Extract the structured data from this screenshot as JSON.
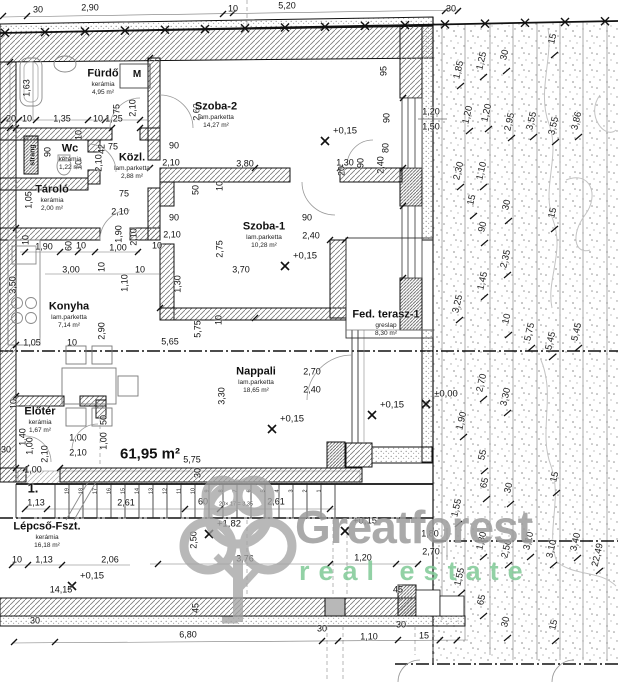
{
  "plan": {
    "unit_number": "1.",
    "total_area": "61,95 m²",
    "stair_note": "20× 17 = 3,35",
    "riser_label": "strang",
    "washer_label": "M"
  },
  "watermark": {
    "brand": "Greatforest",
    "tagline": "real estate",
    "brand_color": "#9c9c9c",
    "tagline_color": "#7fca96"
  },
  "rooms": [
    {
      "name": "Fürdő",
      "finish": "kerámia",
      "area": "4,95 m²",
      "x": 103,
      "y": 74
    },
    {
      "name": "Wc",
      "finish": "kerámia",
      "area": "1,22 m²",
      "x": 70,
      "y": 149
    },
    {
      "name": "Közl.",
      "finish": "lam.parketta",
      "area": "2,88 m²",
      "x": 132,
      "y": 158
    },
    {
      "name": "Tároló",
      "finish": "kerámia",
      "area": "2,00 m²",
      "x": 52,
      "y": 190
    },
    {
      "name": "Szoba-2",
      "finish": "lam.parketta",
      "area": "14,27 m²",
      "x": 216,
      "y": 107
    },
    {
      "name": "Szoba-1",
      "finish": "lam.parketta",
      "area": "10,28 m²",
      "x": 264,
      "y": 227
    },
    {
      "name": "Konyha",
      "finish": "lam.parketta",
      "area": "7,14 m²",
      "x": 69,
      "y": 307
    },
    {
      "name": "Nappali",
      "finish": "lam.parketta",
      "area": "18,65 m²",
      "x": 256,
      "y": 372
    },
    {
      "name": "Fed. terasz-1",
      "finish": "greslap",
      "area": "8,30 m²",
      "x": 386,
      "y": 315
    },
    {
      "name": "Előtér",
      "finish": "kerámia",
      "area": "1,67 m²",
      "x": 40,
      "y": 412
    },
    {
      "name": "Lépcső-Fszt.",
      "finish": "kerámia",
      "area": "16,18 m²",
      "x": 47,
      "y": 527
    }
  ],
  "levels": [
    {
      "t": "+0,15",
      "x": 345,
      "y": 131
    },
    {
      "t": "+0,15",
      "x": 305,
      "y": 256
    },
    {
      "t": "+0,15",
      "x": 292,
      "y": 419
    },
    {
      "t": "+0,15",
      "x": 392,
      "y": 405
    },
    {
      "t": "±0,00",
      "x": 446,
      "y": 394
    },
    {
      "t": "+0,15",
      "x": 365,
      "y": 521
    },
    {
      "t": "+1,82",
      "x": 229,
      "y": 524
    },
    {
      "t": "+0,15",
      "x": 92,
      "y": 576
    }
  ],
  "dims": [
    {
      "t": "30",
      "x": 38,
      "y": 10,
      "k": "h"
    },
    {
      "t": "2,90",
      "x": 90,
      "y": 8,
      "k": "h"
    },
    {
      "t": "10",
      "x": 233,
      "y": 9,
      "k": "h"
    },
    {
      "t": "5,20",
      "x": 287,
      "y": 6,
      "k": "h"
    },
    {
      "t": "30",
      "x": 451,
      "y": 9,
      "k": "h"
    },
    {
      "t": "20",
      "x": 11,
      "y": 119,
      "k": "h"
    },
    {
      "t": "10",
      "x": 27,
      "y": 119,
      "k": "h"
    },
    {
      "t": "1,35",
      "x": 62,
      "y": 119,
      "k": "h"
    },
    {
      "t": "10",
      "x": 98,
      "y": 119,
      "k": "h"
    },
    {
      "t": "1,25",
      "x": 114,
      "y": 119,
      "k": "h"
    },
    {
      "t": "1,63",
      "x": 27,
      "y": 88,
      "k": "v"
    },
    {
      "t": "75",
      "x": 117,
      "y": 109,
      "k": "v"
    },
    {
      "t": "2,10",
      "x": 133,
      "y": 108,
      "k": "v"
    },
    {
      "t": "2,63",
      "x": 197,
      "y": 112,
      "k": "v"
    },
    {
      "t": "95",
      "x": 384,
      "y": 71,
      "k": "v"
    },
    {
      "t": "90",
      "x": 387,
      "y": 118,
      "k": "v"
    },
    {
      "t": "1,20",
      "x": 431,
      "y": 112,
      "k": "h"
    },
    {
      "t": "1,50",
      "x": 431,
      "y": 127,
      "k": "h"
    },
    {
      "t": "80",
      "x": 386,
      "y": 148,
      "k": "v"
    },
    {
      "t": "2,40",
      "x": 381,
      "y": 165,
      "k": "v"
    },
    {
      "t": "90",
      "x": 361,
      "y": 163,
      "k": "v"
    },
    {
      "t": "20",
      "x": 342,
      "y": 171,
      "k": "v"
    },
    {
      "t": "1,30",
      "x": 345,
      "y": 163,
      "k": "h"
    },
    {
      "t": "3,80",
      "x": 245,
      "y": 164,
      "k": "h"
    },
    {
      "t": "50",
      "x": 196,
      "y": 190,
      "k": "v"
    },
    {
      "t": "10",
      "x": 220,
      "y": 186,
      "k": "v"
    },
    {
      "t": "42",
      "x": 102,
      "y": 149,
      "k": "v"
    },
    {
      "t": "75",
      "x": 113,
      "y": 147,
      "k": "h"
    },
    {
      "t": "2,10",
      "x": 99,
      "y": 163,
      "k": "v"
    },
    {
      "t": "90",
      "x": 174,
      "y": 146,
      "k": "h"
    },
    {
      "t": "2,10",
      "x": 171,
      "y": 163,
      "k": "h"
    },
    {
      "t": "10",
      "x": 79,
      "y": 135,
      "k": "v"
    },
    {
      "t": "90",
      "x": 48,
      "y": 152,
      "k": "v"
    },
    {
      "t": "10",
      "x": 79,
      "y": 165,
      "k": "v"
    },
    {
      "t": "1,05",
      "x": 29,
      "y": 200,
      "k": "v"
    },
    {
      "t": "75",
      "x": 124,
      "y": 194,
      "k": "h"
    },
    {
      "t": "2,10",
      "x": 120,
      "y": 212,
      "k": "h"
    },
    {
      "t": "90",
      "x": 174,
      "y": 218,
      "k": "h"
    },
    {
      "t": "2,10",
      "x": 172,
      "y": 235,
      "k": "h"
    },
    {
      "t": "10",
      "x": 157,
      "y": 246,
      "k": "h"
    },
    {
      "t": "90",
      "x": 307,
      "y": 218,
      "k": "h"
    },
    {
      "t": "2,40",
      "x": 311,
      "y": 236,
      "k": "h"
    },
    {
      "t": "2,75",
      "x": 220,
      "y": 249,
      "k": "v"
    },
    {
      "t": "3,70",
      "x": 241,
      "y": 270,
      "k": "h"
    },
    {
      "t": "1,30",
      "x": 178,
      "y": 284,
      "k": "v"
    },
    {
      "t": "5,75",
      "x": 198,
      "y": 329,
      "k": "v"
    },
    {
      "t": "10",
      "x": 219,
      "y": 320,
      "k": "v"
    },
    {
      "t": "5,65",
      "x": 170,
      "y": 342,
      "k": "h"
    },
    {
      "t": "10",
      "x": 26,
      "y": 240,
      "k": "v"
    },
    {
      "t": "1,90",
      "x": 44,
      "y": 247,
      "k": "h"
    },
    {
      "t": "60",
      "x": 69,
      "y": 246,
      "k": "v"
    },
    {
      "t": "10",
      "x": 81,
      "y": 246,
      "k": "h"
    },
    {
      "t": "1,90",
      "x": 119,
      "y": 234,
      "k": "v"
    },
    {
      "t": "2,10",
      "x": 134,
      "y": 237,
      "k": "v"
    },
    {
      "t": "1,00",
      "x": 118,
      "y": 248,
      "k": "h"
    },
    {
      "t": "3,00",
      "x": 71,
      "y": 270,
      "k": "h"
    },
    {
      "t": "10",
      "x": 102,
      "y": 267,
      "k": "v"
    },
    {
      "t": "10",
      "x": 140,
      "y": 270,
      "k": "h"
    },
    {
      "t": "1,10",
      "x": 125,
      "y": 283,
      "k": "v"
    },
    {
      "t": "3,50",
      "x": 13,
      "y": 285,
      "k": "v"
    },
    {
      "t": "1,05",
      "x": 32,
      "y": 343,
      "k": "h"
    },
    {
      "t": "10",
      "x": 72,
      "y": 343,
      "k": "h"
    },
    {
      "t": "2,90",
      "x": 102,
      "y": 331,
      "k": "v"
    },
    {
      "t": "3,30",
      "x": 222,
      "y": 396,
      "k": "v"
    },
    {
      "t": "2,70",
      "x": 312,
      "y": 372,
      "k": "h"
    },
    {
      "t": "2,40",
      "x": 312,
      "y": 390,
      "k": "h"
    },
    {
      "t": "5,75",
      "x": 192,
      "y": 460,
      "k": "h"
    },
    {
      "t": "30",
      "x": 198,
      "y": 473,
      "k": "v"
    },
    {
      "t": "10",
      "x": 14,
      "y": 404,
      "k": "v"
    },
    {
      "t": "1,40",
      "x": 23,
      "y": 437,
      "k": "v"
    },
    {
      "t": "1,00",
      "x": 30,
      "y": 446,
      "k": "v"
    },
    {
      "t": "2,10",
      "x": 45,
      "y": 454,
      "k": "v"
    },
    {
      "t": "30",
      "x": 6,
      "y": 450,
      "k": "h"
    },
    {
      "t": "1,00",
      "x": 33,
      "y": 470,
      "k": "h"
    },
    {
      "t": "1,00",
      "x": 78,
      "y": 438,
      "k": "h"
    },
    {
      "t": "2,10",
      "x": 78,
      "y": 453,
      "k": "h"
    },
    {
      "t": "50",
      "x": 104,
      "y": 420,
      "k": "v"
    },
    {
      "t": "1,00",
      "x": 104,
      "y": 441,
      "k": "v"
    },
    {
      "t": "1,13",
      "x": 36,
      "y": 503,
      "k": "h"
    },
    {
      "t": "2,61",
      "x": 126,
      "y": 503,
      "k": "h"
    },
    {
      "t": "60",
      "x": 203,
      "y": 502,
      "k": "h"
    },
    {
      "t": "2,61",
      "x": 276,
      "y": 502,
      "k": "h"
    },
    {
      "t": "10",
      "x": 17,
      "y": 560,
      "k": "h"
    },
    {
      "t": "1,13",
      "x": 44,
      "y": 560,
      "k": "h"
    },
    {
      "t": "2,06",
      "x": 110,
      "y": 560,
      "k": "h"
    },
    {
      "t": "14,15",
      "x": 61,
      "y": 590,
      "k": "h"
    },
    {
      "t": "2,50",
      "x": 194,
      "y": 540,
      "k": "v"
    },
    {
      "t": "45",
      "x": 196,
      "y": 608,
      "k": "v"
    },
    {
      "t": "3,76",
      "x": 245,
      "y": 559,
      "k": "h"
    },
    {
      "t": "1,20",
      "x": 363,
      "y": 558,
      "k": "h"
    },
    {
      "t": "45",
      "x": 398,
      "y": 590,
      "k": "h"
    },
    {
      "t": "30",
      "x": 401,
      "y": 625,
      "k": "h"
    },
    {
      "t": "30",
      "x": 35,
      "y": 621,
      "k": "h"
    },
    {
      "t": "6,80",
      "x": 188,
      "y": 635,
      "k": "h"
    },
    {
      "t": "30",
      "x": 322,
      "y": 629,
      "k": "h"
    },
    {
      "t": "1,10",
      "x": 369,
      "y": 637,
      "k": "h"
    },
    {
      "t": "15",
      "x": 424,
      "y": 636,
      "k": "h"
    },
    {
      "t": "1,80",
      "x": 430,
      "y": 534,
      "k": "h"
    },
    {
      "t": "2,70",
      "x": 431,
      "y": 552,
      "k": "h"
    },
    {
      "t": "1,85",
      "x": 459,
      "y": 70,
      "k": "g"
    },
    {
      "t": "1,25",
      "x": 482,
      "y": 61,
      "k": "g"
    },
    {
      "t": "30",
      "x": 505,
      "y": 55,
      "k": "g"
    },
    {
      "t": "15",
      "x": 553,
      "y": 39,
      "k": "g"
    },
    {
      "t": "1,20",
      "x": 468,
      "y": 115,
      "k": "g"
    },
    {
      "t": "1,20",
      "x": 487,
      "y": 113,
      "k": "g"
    },
    {
      "t": "2,95",
      "x": 510,
      "y": 122,
      "k": "g"
    },
    {
      "t": "3,55",
      "x": 532,
      "y": 121,
      "k": "g"
    },
    {
      "t": "3,55",
      "x": 554,
      "y": 126,
      "k": "g"
    },
    {
      "t": "3,86",
      "x": 577,
      "y": 121,
      "k": "g"
    },
    {
      "t": "2,30",
      "x": 459,
      "y": 171,
      "k": "g"
    },
    {
      "t": "1,10",
      "x": 482,
      "y": 171,
      "k": "g"
    },
    {
      "t": "15",
      "x": 472,
      "y": 200,
      "k": "g"
    },
    {
      "t": "90",
      "x": 483,
      "y": 227,
      "k": "g"
    },
    {
      "t": "30",
      "x": 507,
      "y": 205,
      "k": "g"
    },
    {
      "t": "15",
      "x": 553,
      "y": 213,
      "k": "g"
    },
    {
      "t": "2,35",
      "x": 506,
      "y": 259,
      "k": "g"
    },
    {
      "t": "1,45",
      "x": 483,
      "y": 281,
      "k": "g"
    },
    {
      "t": "3,25",
      "x": 458,
      "y": 304,
      "k": "g"
    },
    {
      "t": "10",
      "x": 507,
      "y": 319,
      "k": "g"
    },
    {
      "t": "5,75",
      "x": 530,
      "y": 332,
      "k": "g"
    },
    {
      "t": "5,45",
      "x": 551,
      "y": 341,
      "k": "g"
    },
    {
      "t": "5,45",
      "x": 577,
      "y": 332,
      "k": "g"
    },
    {
      "t": "2,70",
      "x": 482,
      "y": 383,
      "k": "g"
    },
    {
      "t": "3,30",
      "x": 506,
      "y": 397,
      "k": "g"
    },
    {
      "t": "1,90",
      "x": 462,
      "y": 421,
      "k": "g"
    },
    {
      "t": "55",
      "x": 483,
      "y": 455,
      "k": "g"
    },
    {
      "t": "65",
      "x": 485,
      "y": 483,
      "k": "g"
    },
    {
      "t": "30",
      "x": 509,
      "y": 488,
      "k": "g"
    },
    {
      "t": "15",
      "x": 555,
      "y": 477,
      "k": "g"
    },
    {
      "t": "1,55",
      "x": 457,
      "y": 508,
      "k": "g"
    },
    {
      "t": "1,80",
      "x": 482,
      "y": 541,
      "k": "g"
    },
    {
      "t": "2,50",
      "x": 507,
      "y": 549,
      "k": "g"
    },
    {
      "t": "3,10",
      "x": 529,
      "y": 541,
      "k": "g"
    },
    {
      "t": "3,10",
      "x": 552,
      "y": 549,
      "k": "g"
    },
    {
      "t": "3,40",
      "x": 576,
      "y": 542,
      "k": "g"
    },
    {
      "t": "22,49",
      "x": 598,
      "y": 555,
      "k": "g"
    },
    {
      "t": "1,55",
      "x": 460,
      "y": 577,
      "k": "g"
    },
    {
      "t": "65",
      "x": 482,
      "y": 600,
      "k": "g"
    },
    {
      "t": "30",
      "x": 506,
      "y": 622,
      "k": "g"
    },
    {
      "t": "15",
      "x": 554,
      "y": 625,
      "k": "g"
    }
  ],
  "stair_steps": [
    "19",
    "18",
    "17",
    "16",
    "15",
    "14",
    "13",
    "12",
    "11",
    "10",
    "9",
    "8",
    "7",
    "6",
    "5",
    "4",
    "3",
    "2",
    "1"
  ]
}
